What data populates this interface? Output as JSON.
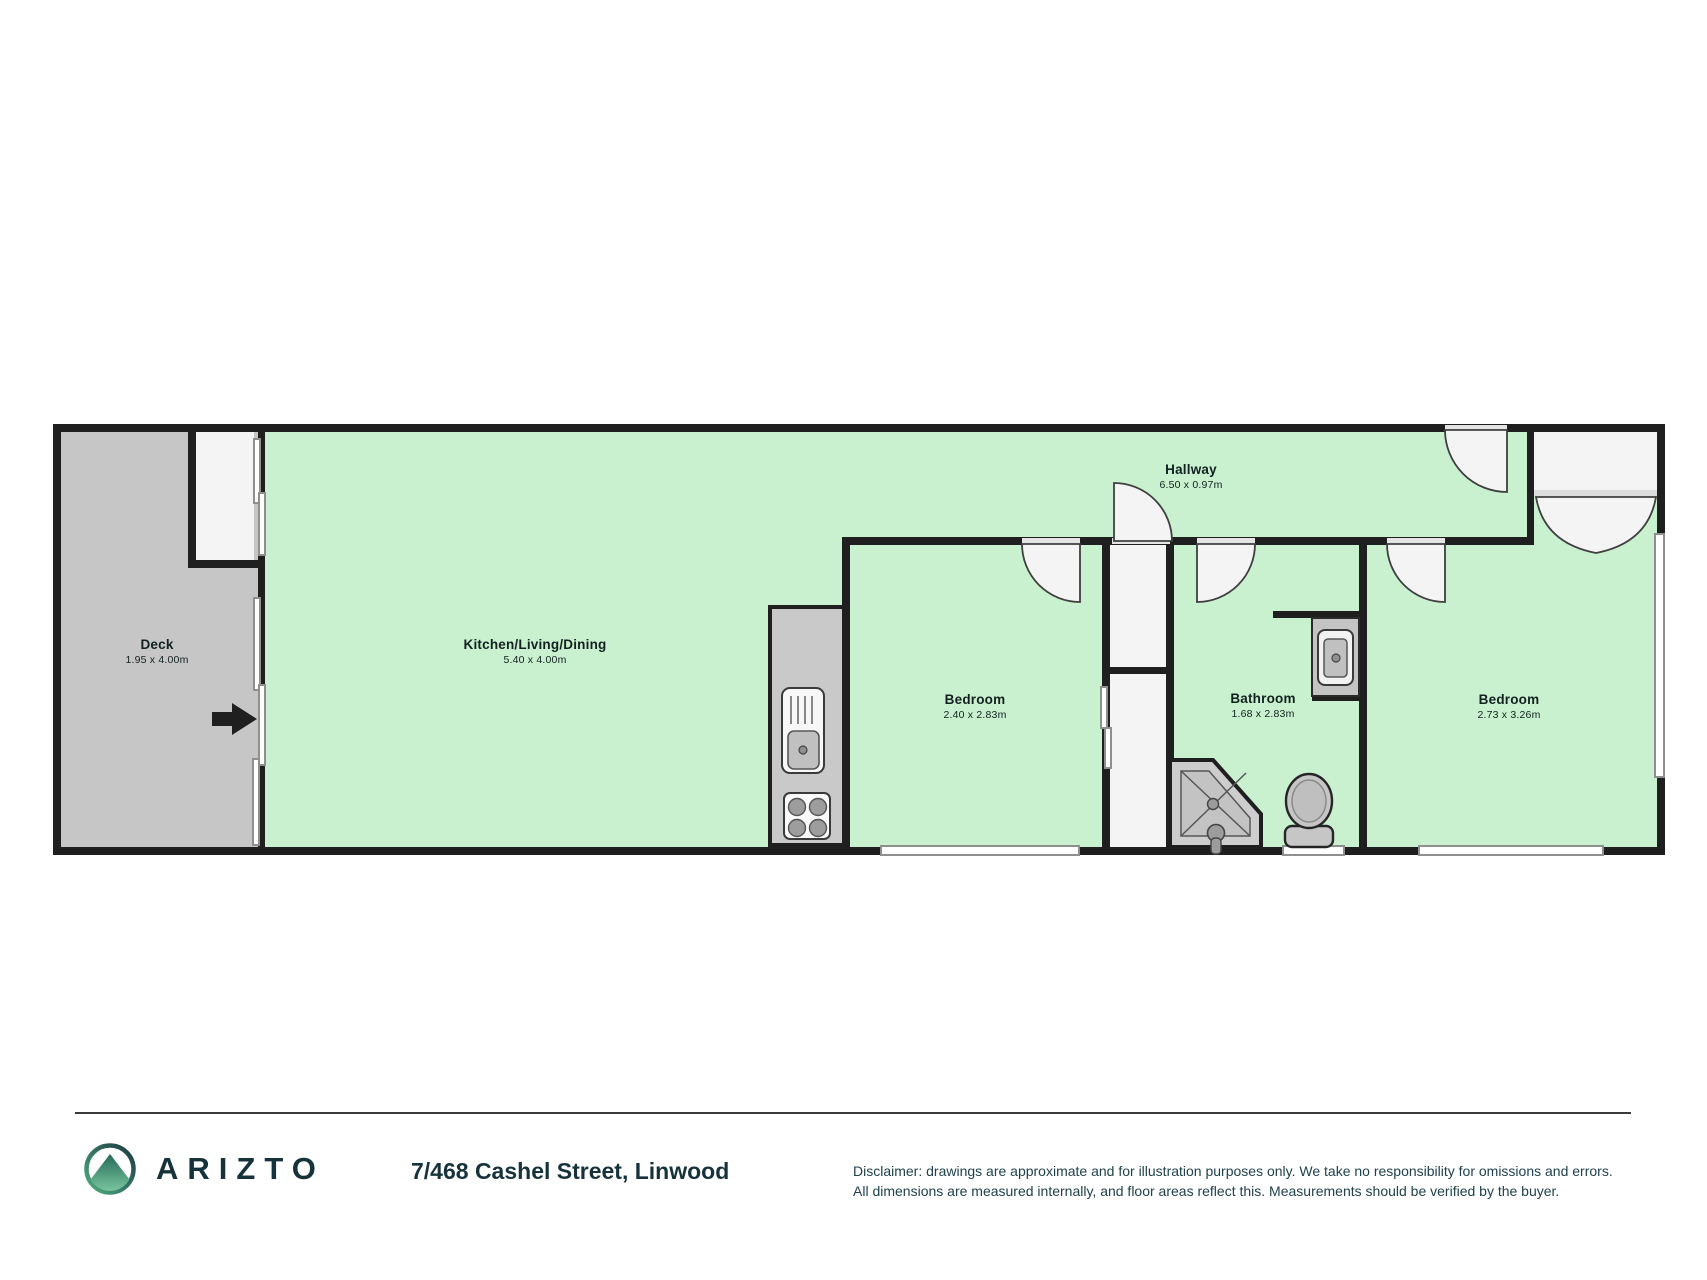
{
  "plan": {
    "rooms": [
      {
        "name": "Deck",
        "dims": "1.95 x 4.00m"
      },
      {
        "name": "Kitchen/Living/Dining",
        "dims": "5.40 x 4.00m"
      },
      {
        "name": "Hallway",
        "dims": "6.50 x 0.97m"
      },
      {
        "name": "Bedroom",
        "dims": "2.40 x 2.83m"
      },
      {
        "name": "Bathroom",
        "dims": "1.68 x 2.83m"
      },
      {
        "name": "Bedroom",
        "dims": "2.73 x 3.26m"
      }
    ],
    "fixtures": [
      "kitchen-sink",
      "cooktop",
      "bathroom-vanity-sink",
      "shower",
      "toilet",
      "wardrobe-sliding-doors",
      "entry-arrow",
      "hinged-doors",
      "french-doors",
      "windows"
    ],
    "colors": {
      "room_fill": "#c9f1cf",
      "deck_fill": "#c6c6c6",
      "wall": "#1f1f1f",
      "fixture_gray": "#c6c6c6",
      "brand_teal": "#16333c",
      "brand_green": "#4aa97d"
    }
  },
  "footer": {
    "brand": "ARIZTO",
    "address": "7/468 Cashel Street, Linwood",
    "disclaimer_line1": "Disclaimer: drawings are approximate and for illustration purposes only. We take no responsibility for omissions and errors.",
    "disclaimer_line2": "All dimensions are measured internally, and floor areas reflect this. Measurements should be verified by the buyer."
  }
}
